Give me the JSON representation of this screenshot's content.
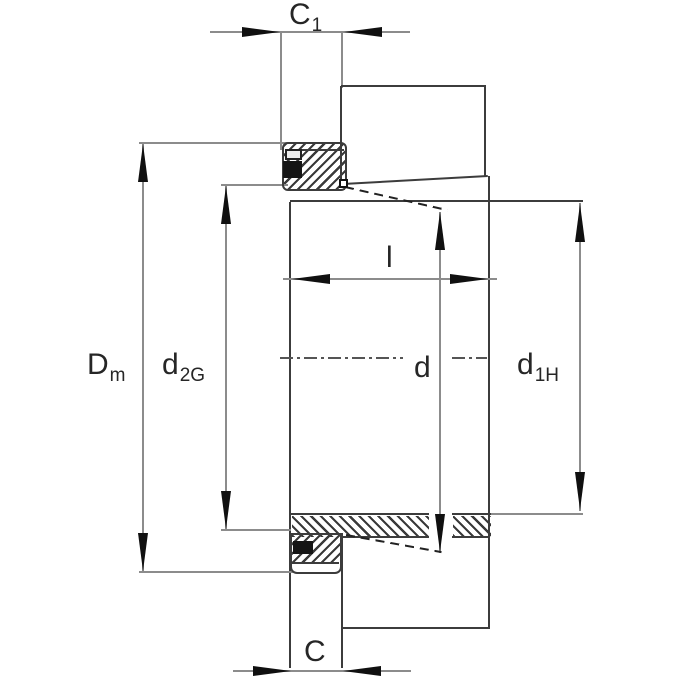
{
  "drawing": {
    "width": 680,
    "height": 680,
    "colors": {
      "object_line": "#3c3c3c",
      "dimension_line": "#8c8c8c",
      "arrow": "#101010",
      "hatch_stroke": "#3a3a3a",
      "text": "#262626",
      "background": "#ffffff"
    },
    "labels": [
      {
        "n": "dim-label-c1",
        "main": "C",
        "sub": "1",
        "x": 289,
        "y": 0,
        "fs": 30,
        "sfs": 19
      },
      {
        "n": "dim-label-dm",
        "main": "D",
        "sub": "m",
        "x": 87,
        "y": 350,
        "fs": 30,
        "sfs": 19
      },
      {
        "n": "dim-label-d2g",
        "main": "d",
        "sub": "2G",
        "x": 162,
        "y": 350,
        "fs": 30,
        "sfs": 19
      },
      {
        "n": "dim-label-l",
        "main": "l",
        "sub": "",
        "x": 386,
        "y": 243,
        "fs": 30,
        "sfs": 19
      },
      {
        "n": "dim-label-d",
        "main": "d",
        "sub": "",
        "x": 414,
        "y": 353,
        "fs": 30,
        "sfs": 19
      },
      {
        "n": "dim-label-d1h",
        "main": "d",
        "sub": "1H",
        "x": 517,
        "y": 350,
        "fs": 30,
        "sfs": 19
      },
      {
        "n": "dim-label-c",
        "main": "C",
        "sub": "",
        "x": 304,
        "y": 637,
        "fs": 30,
        "sfs": 19
      }
    ],
    "hatches": [
      {
        "n": "top-locknut-hatch",
        "x": 284,
        "y": 144,
        "w": 61,
        "h": 46,
        "dir": 135
      },
      {
        "n": "sleeve-band-left-hatch",
        "x": 292,
        "y": 516,
        "w": 137,
        "h": 21,
        "dir": 45
      },
      {
        "n": "sleeve-band-right-hatch",
        "x": 453,
        "y": 516,
        "w": 38,
        "h": 21,
        "dir": 45
      },
      {
        "n": "bottom-locknut-hatch",
        "x": 291,
        "y": 534,
        "w": 50,
        "h": 28,
        "dir": 135
      }
    ],
    "lines": [
      {
        "n": "c1-dimension-line",
        "x1": 210,
        "y1": 32,
        "x2": 410,
        "y2": 32,
        "c": "dim"
      },
      {
        "n": "c1-extension-left",
        "x1": 281,
        "y1": 32,
        "x2": 281,
        "y2": 150,
        "c": "dim"
      },
      {
        "n": "c1-extension-right",
        "x1": 342,
        "y1": 32,
        "x2": 342,
        "y2": 88,
        "c": "dim"
      },
      {
        "n": "bearing-top-left-edge",
        "x1": 341,
        "y1": 86,
        "x2": 341,
        "y2": 187,
        "c": "obj"
      },
      {
        "n": "bearing-top-top-edge",
        "x1": 341,
        "y1": 86,
        "x2": 486,
        "y2": 86,
        "c": "obj"
      },
      {
        "n": "bearing-top-right-edge",
        "x1": 485,
        "y1": 86,
        "x2": 485,
        "y2": 177,
        "c": "obj"
      },
      {
        "n": "taper-surface-top",
        "x1": 343,
        "y1": 184,
        "x2": 488,
        "y2": 176,
        "c": "obj"
      },
      {
        "n": "bore-line-and-d1h-ext",
        "x1": 290,
        "y1": 201,
        "x2": 583,
        "y2": 201,
        "c": "obj"
      },
      {
        "n": "sleeve-right-face",
        "x1": 489,
        "y1": 176,
        "x2": 489,
        "y2": 628,
        "c": "obj"
      },
      {
        "n": "sleeve-left-face",
        "x1": 290,
        "y1": 202,
        "x2": 290,
        "y2": 668,
        "c": "obj"
      },
      {
        "n": "top-locknut-inner-line",
        "x1": 286,
        "y1": 150,
        "x2": 344,
        "y2": 150,
        "c": "obj",
        "w": 1.5
      },
      {
        "n": "dm-dimension-line",
        "x1": 143,
        "y1": 143,
        "x2": 143,
        "y2": 572,
        "c": "dim"
      },
      {
        "n": "dm-extension-top",
        "x1": 139,
        "y1": 143,
        "x2": 288,
        "y2": 143,
        "c": "dim"
      },
      {
        "n": "dm-extension-bottom",
        "x1": 139,
        "y1": 572,
        "x2": 294,
        "y2": 572,
        "c": "dim"
      },
      {
        "n": "d2g-dimension-line",
        "x1": 226,
        "y1": 185,
        "x2": 226,
        "y2": 530,
        "c": "dim"
      },
      {
        "n": "d2g-extension-top",
        "x1": 221,
        "y1": 185,
        "x2": 288,
        "y2": 185,
        "c": "dim"
      },
      {
        "n": "d2g-extension-bottom",
        "x1": 221,
        "y1": 530,
        "x2": 291,
        "y2": 530,
        "c": "dim"
      },
      {
        "n": "l-dimension-line",
        "x1": 283,
        "y1": 279,
        "x2": 497,
        "y2": 279,
        "c": "dim"
      },
      {
        "n": "d-dimension-line",
        "x1": 440,
        "y1": 212,
        "x2": 440,
        "y2": 553,
        "c": "dim"
      },
      {
        "n": "d1h-dimension-line",
        "x1": 580,
        "y1": 203,
        "x2": 580,
        "y2": 511,
        "c": "dim"
      },
      {
        "n": "d1h-extension-bottom",
        "x1": 490,
        "y1": 514,
        "x2": 583,
        "y2": 514,
        "c": "dim"
      },
      {
        "n": "band-left-top-edge",
        "x1": 291,
        "y1": 514,
        "x2": 429,
        "y2": 514,
        "c": "obj"
      },
      {
        "n": "band-left-bottom-edge",
        "x1": 343,
        "y1": 537,
        "x2": 429,
        "y2": 537,
        "c": "obj"
      },
      {
        "n": "band-right-top-edge",
        "x1": 452,
        "y1": 514,
        "x2": 491,
        "y2": 514,
        "c": "obj"
      },
      {
        "n": "band-right-bottom-edge",
        "x1": 452,
        "y1": 537,
        "x2": 490,
        "y2": 537,
        "c": "obj"
      },
      {
        "n": "bottom-locknut-rim-line",
        "x1": 292,
        "y1": 563,
        "x2": 339,
        "y2": 563,
        "c": "obj",
        "w": 1.5
      },
      {
        "n": "bearing-bottom-bottom-edge",
        "x1": 343,
        "y1": 628,
        "x2": 490,
        "y2": 628,
        "c": "obj"
      },
      {
        "n": "bearing-bottom-left-edge",
        "x1": 342,
        "y1": 533,
        "x2": 342,
        "y2": 668,
        "c": "obj"
      },
      {
        "n": "c-dimension-line",
        "x1": 233,
        "y1": 671,
        "x2": 411,
        "y2": 671,
        "c": "dim"
      }
    ],
    "dashes": [
      {
        "n": "slit-projection-top",
        "x1": 345,
        "y1": 187,
        "x2": 447,
        "y2": 210,
        "c": "#222222",
        "w": 2,
        "pat": "plain"
      },
      {
        "n": "slit-projection-bottom",
        "x1": 346,
        "y1": 535,
        "x2": 441,
        "y2": 552,
        "c": "#222222",
        "w": 2,
        "pat": "plain"
      },
      {
        "n": "centerline-left",
        "x1": 280,
        "y1": 358,
        "x2": 403,
        "y2": 358,
        "c": "#555555",
        "w": 1.6,
        "pat": "dashdot"
      },
      {
        "n": "centerline-right",
        "x1": 452,
        "y1": 358,
        "x2": 487,
        "y2": 358,
        "c": "#555555",
        "w": 1.6,
        "pat": "dashdot"
      }
    ],
    "rects": [
      {
        "n": "top-locknut-outline",
        "x": 282,
        "y": 142,
        "w": 65,
        "h": 49,
        "bw": 2,
        "bc": "#3c3c3c",
        "r": "6px"
      },
      {
        "n": "bottom-locknut-outline",
        "x": 290,
        "y": 533,
        "w": 52,
        "h": 41,
        "bw": 2,
        "bc": "#3c3c3c",
        "r": "0 0 7px 7px"
      },
      {
        "n": "top-lockwasher-tab",
        "x": 285,
        "y": 149,
        "w": 17,
        "h": 11,
        "bw": 2,
        "bc": "#222222",
        "bg": "#ededed"
      },
      {
        "n": "top-lockwasher-section",
        "x": 283,
        "y": 161,
        "w": 19,
        "h": 17,
        "bw": 0,
        "bc": "",
        "bg": "#151515"
      },
      {
        "n": "bottom-lockwasher-section",
        "x": 293,
        "y": 541,
        "w": 20,
        "h": 13,
        "bw": 0,
        "bc": "",
        "bg": "#151515"
      },
      {
        "n": "thread-corner-marker",
        "x": 339,
        "y": 179,
        "w": 9,
        "h": 9,
        "bw": 2,
        "bc": "#111111",
        "bg": "#ffffff"
      }
    ],
    "arrows": [
      {
        "n": "c1-arrow-left",
        "dir": "right",
        "x": 280,
        "y": 32
      },
      {
        "n": "c1-arrow-right",
        "dir": "left",
        "x": 344,
        "y": 32
      },
      {
        "n": "dm-arrow-top",
        "dir": "up",
        "x": 143,
        "y": 144
      },
      {
        "n": "dm-arrow-bottom",
        "dir": "down",
        "x": 143,
        "y": 571
      },
      {
        "n": "d2g-arrow-top",
        "dir": "up",
        "x": 226,
        "y": 186
      },
      {
        "n": "d2g-arrow-bottom",
        "dir": "down",
        "x": 226,
        "y": 529
      },
      {
        "n": "l-arrow-left",
        "dir": "left",
        "x": 292,
        "y": 279
      },
      {
        "n": "l-arrow-right",
        "dir": "right",
        "x": 488,
        "y": 279
      },
      {
        "n": "d-arrow-top",
        "dir": "up",
        "x": 440,
        "y": 212
      },
      {
        "n": "d-arrow-bottom",
        "dir": "down",
        "x": 440,
        "y": 552
      },
      {
        "n": "d1h-arrow-top",
        "dir": "up",
        "x": 580,
        "y": 204
      },
      {
        "n": "d1h-arrow-bottom",
        "dir": "down",
        "x": 580,
        "y": 510
      },
      {
        "n": "c-arrow-left",
        "dir": "right",
        "x": 291,
        "y": 671
      },
      {
        "n": "c-arrow-right",
        "dir": "left",
        "x": 343,
        "y": 671
      }
    ],
    "arrow_geometry": {
      "length": 38,
      "width": 10
    }
  }
}
